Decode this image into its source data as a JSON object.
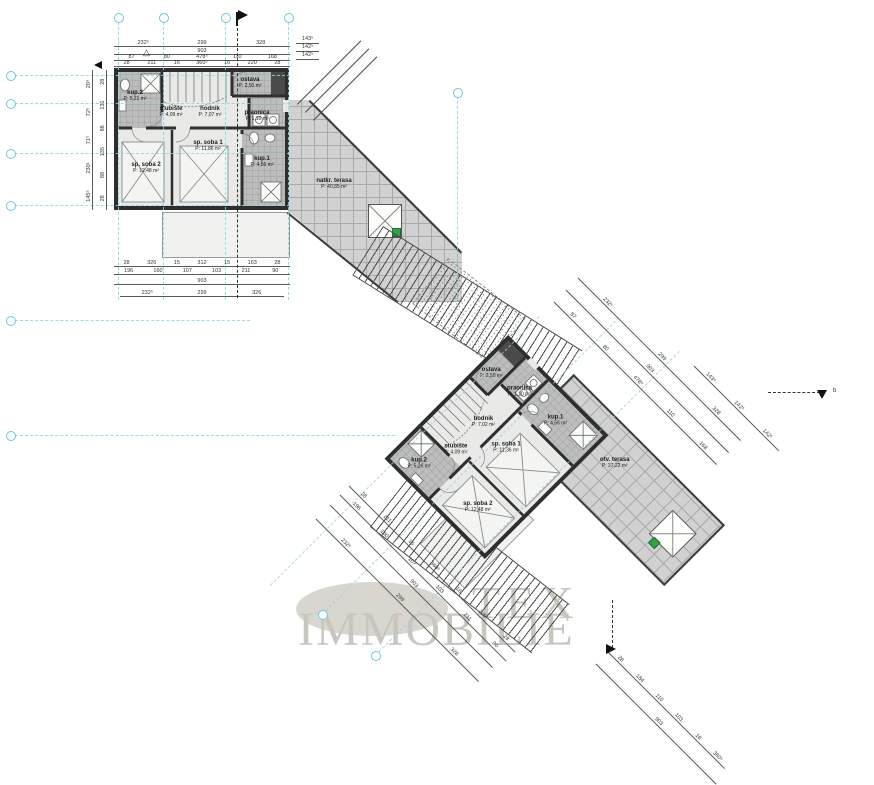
{
  "watermark": {
    "word1": "TEX",
    "word2": "IMMOBILIE"
  },
  "units": {
    "a": {
      "rooms": [
        {
          "id": "kup2",
          "label": "kup.2",
          "area": "P: 5,21 m²"
        },
        {
          "id": "stubiste",
          "label": "stubište",
          "area": "P: 4,09 m²"
        },
        {
          "id": "hodnik",
          "label": "hodnik",
          "area": "P: 7,07 m²"
        },
        {
          "id": "ostava",
          "label": "ostava",
          "area": "P: 2,50 m²"
        },
        {
          "id": "praonica",
          "label": "praonica",
          "area": "P: 1,10 m²"
        },
        {
          "id": "spsoba1",
          "label": "sp. soba 1",
          "area": "P: 11,86 m²"
        },
        {
          "id": "spsoba2",
          "label": "sp. soba 2",
          "area": "P: 12,48 m²"
        },
        {
          "id": "kup1",
          "label": "kup.1",
          "area": "P: 4,56 m²"
        }
      ],
      "terrace": {
        "label": "natkr. terasa",
        "area": "P: 40,85 m²"
      }
    },
    "b": {
      "rooms": [
        {
          "id": "kup2",
          "label": "kup.2",
          "area": "P: 5,26 m²"
        },
        {
          "id": "stubiste",
          "label": "stubište",
          "area": "P: 4,09 m²"
        },
        {
          "id": "hodnik",
          "label": "hodnik",
          "area": "P: 7,02 m²"
        },
        {
          "id": "ostava",
          "label": "ostava",
          "area": "P: 2,50 m²"
        },
        {
          "id": "praonica",
          "label": "praonica",
          "area": "P: 1,10 m²"
        },
        {
          "id": "spsoba1",
          "label": "sp. soba 1",
          "area": "P: 11,36 m²"
        },
        {
          "id": "spsoba2",
          "label": "sp. soba 2",
          "area": "P: 12,48 m²"
        },
        {
          "id": "kup1",
          "label": "kup.1",
          "area": "P: 4,56 m²"
        }
      ],
      "terrace": {
        "label": "otv. terasa",
        "area": "P: 37,22 m²"
      }
    }
  },
  "dimensions": {
    "top": [
      [
        "232⁵",
        "299",
        "328"
      ],
      [
        "903"
      ],
      [
        "87",
        "80",
        "478⁵",
        "110",
        "168"
      ],
      [
        "28",
        "211",
        "16",
        "360⁵",
        "16",
        "220",
        "28"
      ]
    ],
    "right_stack": [
      "143⁵",
      "142⁵",
      "142⁵"
    ],
    "bottom": [
      [
        "28",
        "326",
        "15",
        "312",
        "15",
        "163",
        "28"
      ],
      [
        "196",
        "160",
        "107",
        "103",
        "211",
        "90"
      ],
      [
        "903"
      ],
      [
        "232⁵",
        "299",
        "326"
      ]
    ],
    "left": [
      [
        "145⁵",
        "230¹",
        "71⁵",
        "72⁵",
        "20⁹"
      ],
      [
        "28",
        "88",
        "135",
        "88",
        "131",
        "28"
      ]
    ],
    "diag_sw": [
      [
        "28",
        "211",
        "16",
        "360⁵",
        "16",
        "220",
        "28"
      ],
      [
        "196",
        "160",
        "107",
        "103",
        "211",
        "90"
      ],
      [
        "903"
      ],
      [
        "232⁵",
        "299",
        "326"
      ]
    ],
    "diag_ne": [
      [
        "87",
        "80",
        "478⁵",
        "110",
        "168"
      ],
      [
        "903"
      ],
      [
        "232⁵",
        "299",
        "328"
      ],
      [
        "143⁵",
        "142⁵",
        "142⁵"
      ]
    ],
    "diag_bottom": [
      [
        "28",
        "184",
        "110",
        "103",
        "16",
        "360⁵"
      ],
      [
        "903"
      ]
    ]
  },
  "markers": {
    "section_b_label": "b"
  }
}
